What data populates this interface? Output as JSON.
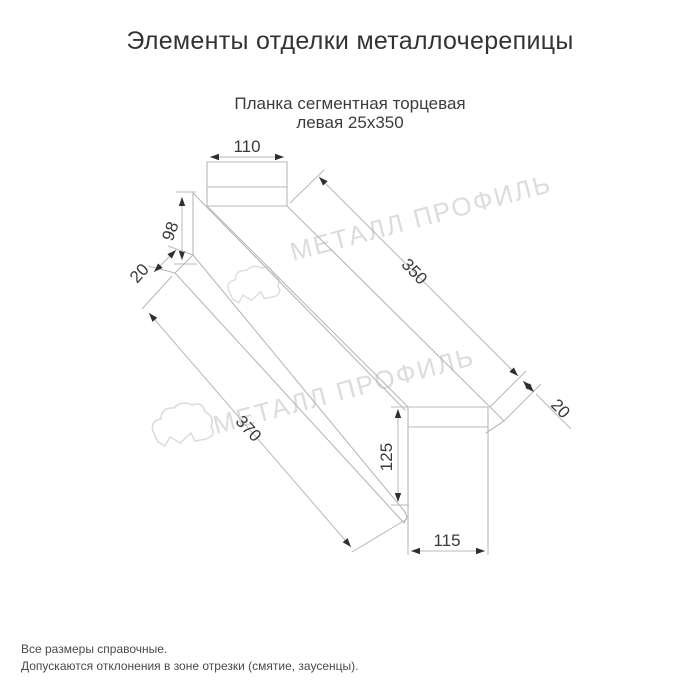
{
  "header": {
    "title": "Элементы отделки металлочерепицы"
  },
  "subtitle": {
    "line1": "Планка сегментная торцевая",
    "line2": "левая 25х350"
  },
  "drawing": {
    "dimensions": {
      "top_width": "110",
      "left_side": "98",
      "left_fold": "20",
      "top_length": "350",
      "right_fold": "20",
      "bottom_length": "370",
      "right_height": "125",
      "bottom_width": "115"
    }
  },
  "watermark": {
    "text": "МЕТАЛЛ ПРОФИЛЬ",
    "logo": "cloud-logo"
  },
  "footer": {
    "line1": "Все размеры справочные.",
    "line2": "Допускаются отклонения в зоне отрезки (смятие, заусенцы)."
  },
  "colors": {
    "background": "#ffffff",
    "line": "#b8b8b8",
    "dim_text": "#3a3a3a",
    "title_text": "#333333",
    "watermark": "#dcdcdc",
    "arrow": "#2f2f2f",
    "footer_text": "#4a4a4a"
  }
}
